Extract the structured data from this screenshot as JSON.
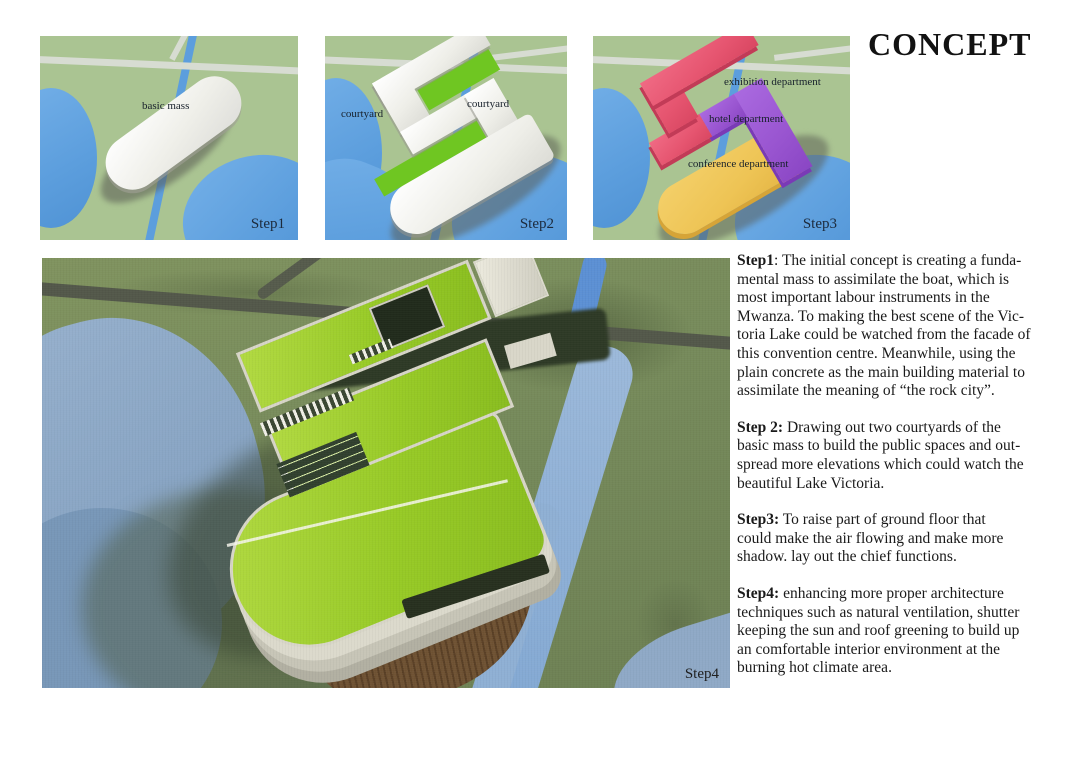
{
  "title": "CONCEPT",
  "panels": [
    {
      "step_label": "Step1",
      "labels": {
        "basic_mass": "basic mass"
      }
    },
    {
      "step_label": "Step2",
      "labels": {
        "courtyard_left": "courtyard",
        "courtyard_right": "courtyard"
      }
    },
    {
      "step_label": "Step3",
      "labels": {
        "exhibition": "exhibition department",
        "hotel": "hotel department",
        "conference": "conference department"
      }
    }
  ],
  "render": {
    "step_label": "Step4"
  },
  "descriptions": [
    {
      "label": "Step1",
      "rest_lines": [
        ": The initial concept is creating a funda-",
        "mental mass to assimilate the boat, which is",
        "most important labour instruments in the",
        "Mwanza. To making the best scene of the Vic-",
        "toria Lake could be watched from the facade of",
        "this convention centre. Meanwhile, using the",
        "plain concrete as the main building material to",
        "assimilate the meaning of “the rock city”."
      ]
    },
    {
      "label": "Step 2:",
      "rest_lines": [
        " Drawing out two courtyards of the",
        "basic mass to build the public spaces and out-",
        "spread more elevations which could watch the",
        "beautiful Lake Victoria."
      ]
    },
    {
      "label": "Step3:",
      "rest_lines": [
        " To raise part of ground floor that",
        "could make the air flowing and make more",
        "shadow. lay out the chief functions."
      ]
    },
    {
      "label": "Step4:",
      "rest_lines": [
        " enhancing more proper architecture",
        "techniques such as natural ventilation, shutter",
        "keeping the sun and roof greening to build up",
        "an comfortable interior environment at the",
        "burning hot climate area."
      ]
    }
  ],
  "colors": {
    "map_green": "#aac492",
    "water_blue": "#5c9edd",
    "road_gray": "#d7dcd2",
    "mass_white": "#f5f5f0",
    "courtyard_green": "#6fc622",
    "exhibition_red": "#e65570",
    "hotel_purple": "#9955d0",
    "conference_yellow": "#eec455",
    "render_grass_olive": "#75895a",
    "roof_green": "#97ca26",
    "deck_brown": "#6f5233",
    "river_steel_blue": "#8fa9c6",
    "title_black": "#121212"
  }
}
